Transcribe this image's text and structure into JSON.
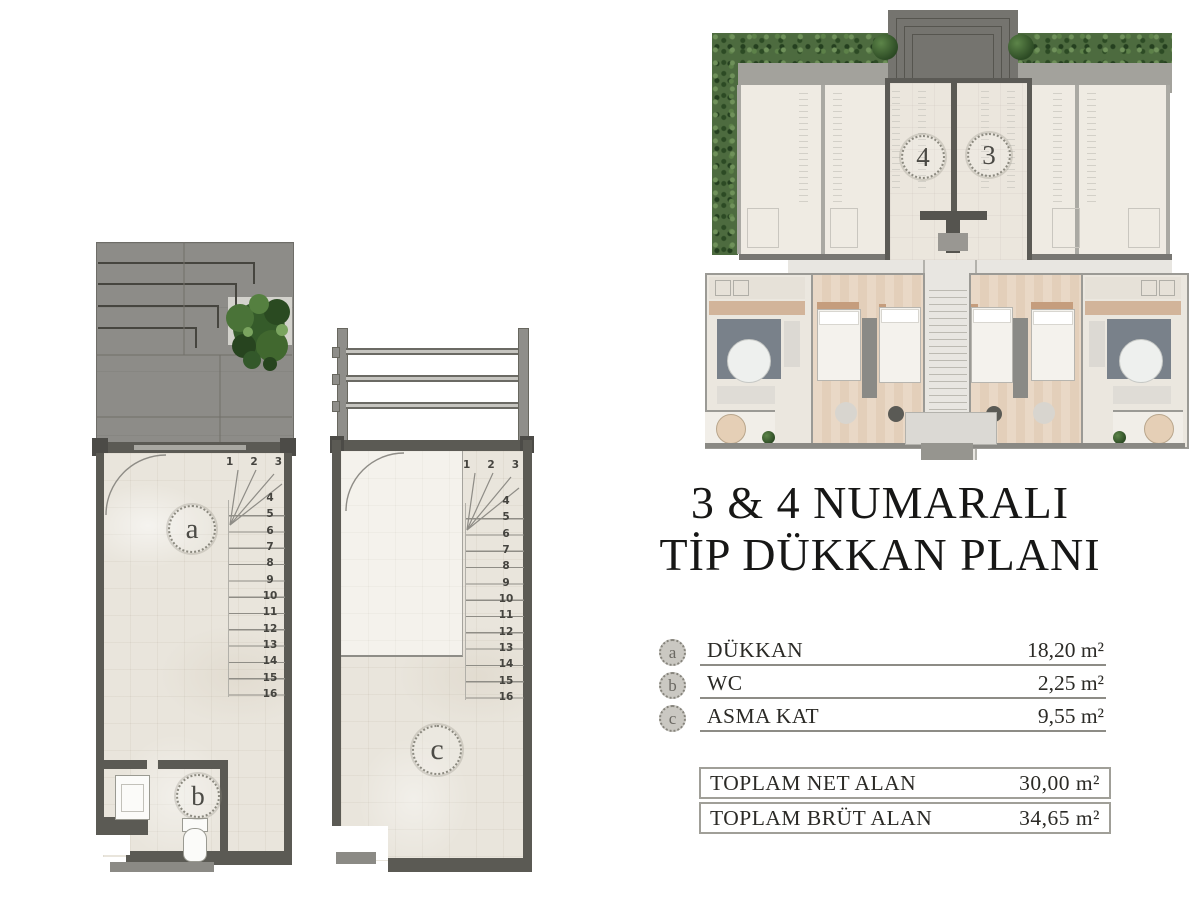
{
  "document": {
    "title_line1": "3 & 4 NUMARALI",
    "title_line2": "TİP DÜKKAN PLANI"
  },
  "site_plan": {
    "unit4_label": "4",
    "unit3_label": "3"
  },
  "ground_plan": {
    "label_a": "a",
    "label_b": "b",
    "stair_top": [
      "1",
      "2",
      "3"
    ],
    "stair_side": [
      "4",
      "5",
      "6",
      "7",
      "8",
      "9",
      "10",
      "11",
      "12",
      "13",
      "14",
      "15",
      "16"
    ]
  },
  "mezzanine_plan": {
    "label_c": "c",
    "stair_top": [
      "1",
      "2",
      "3"
    ],
    "stair_side": [
      "4",
      "5",
      "6",
      "7",
      "8",
      "9",
      "10",
      "11",
      "12",
      "13",
      "14",
      "15",
      "16"
    ]
  },
  "legend": {
    "rows": [
      {
        "key": "a",
        "label": "DÜKKAN",
        "value": "18,20 m²"
      },
      {
        "key": "b",
        "label": "WC",
        "value": "2,25 m²"
      },
      {
        "key": "c",
        "label": "ASMA KAT",
        "value": "9,55 m²"
      }
    ]
  },
  "totals": {
    "rows": [
      {
        "label": "TOPLAM NET ALAN",
        "value": "30,00 m²"
      },
      {
        "label": "TOPLAM BRÜT ALAN",
        "value": "34,65 m²"
      }
    ]
  },
  "colors": {
    "wall": "#5b5a54",
    "roof": "#8d8c88",
    "floor": "#e9e5dc",
    "hedge_green": "#4d6b3f",
    "text": "#2b2a26"
  }
}
